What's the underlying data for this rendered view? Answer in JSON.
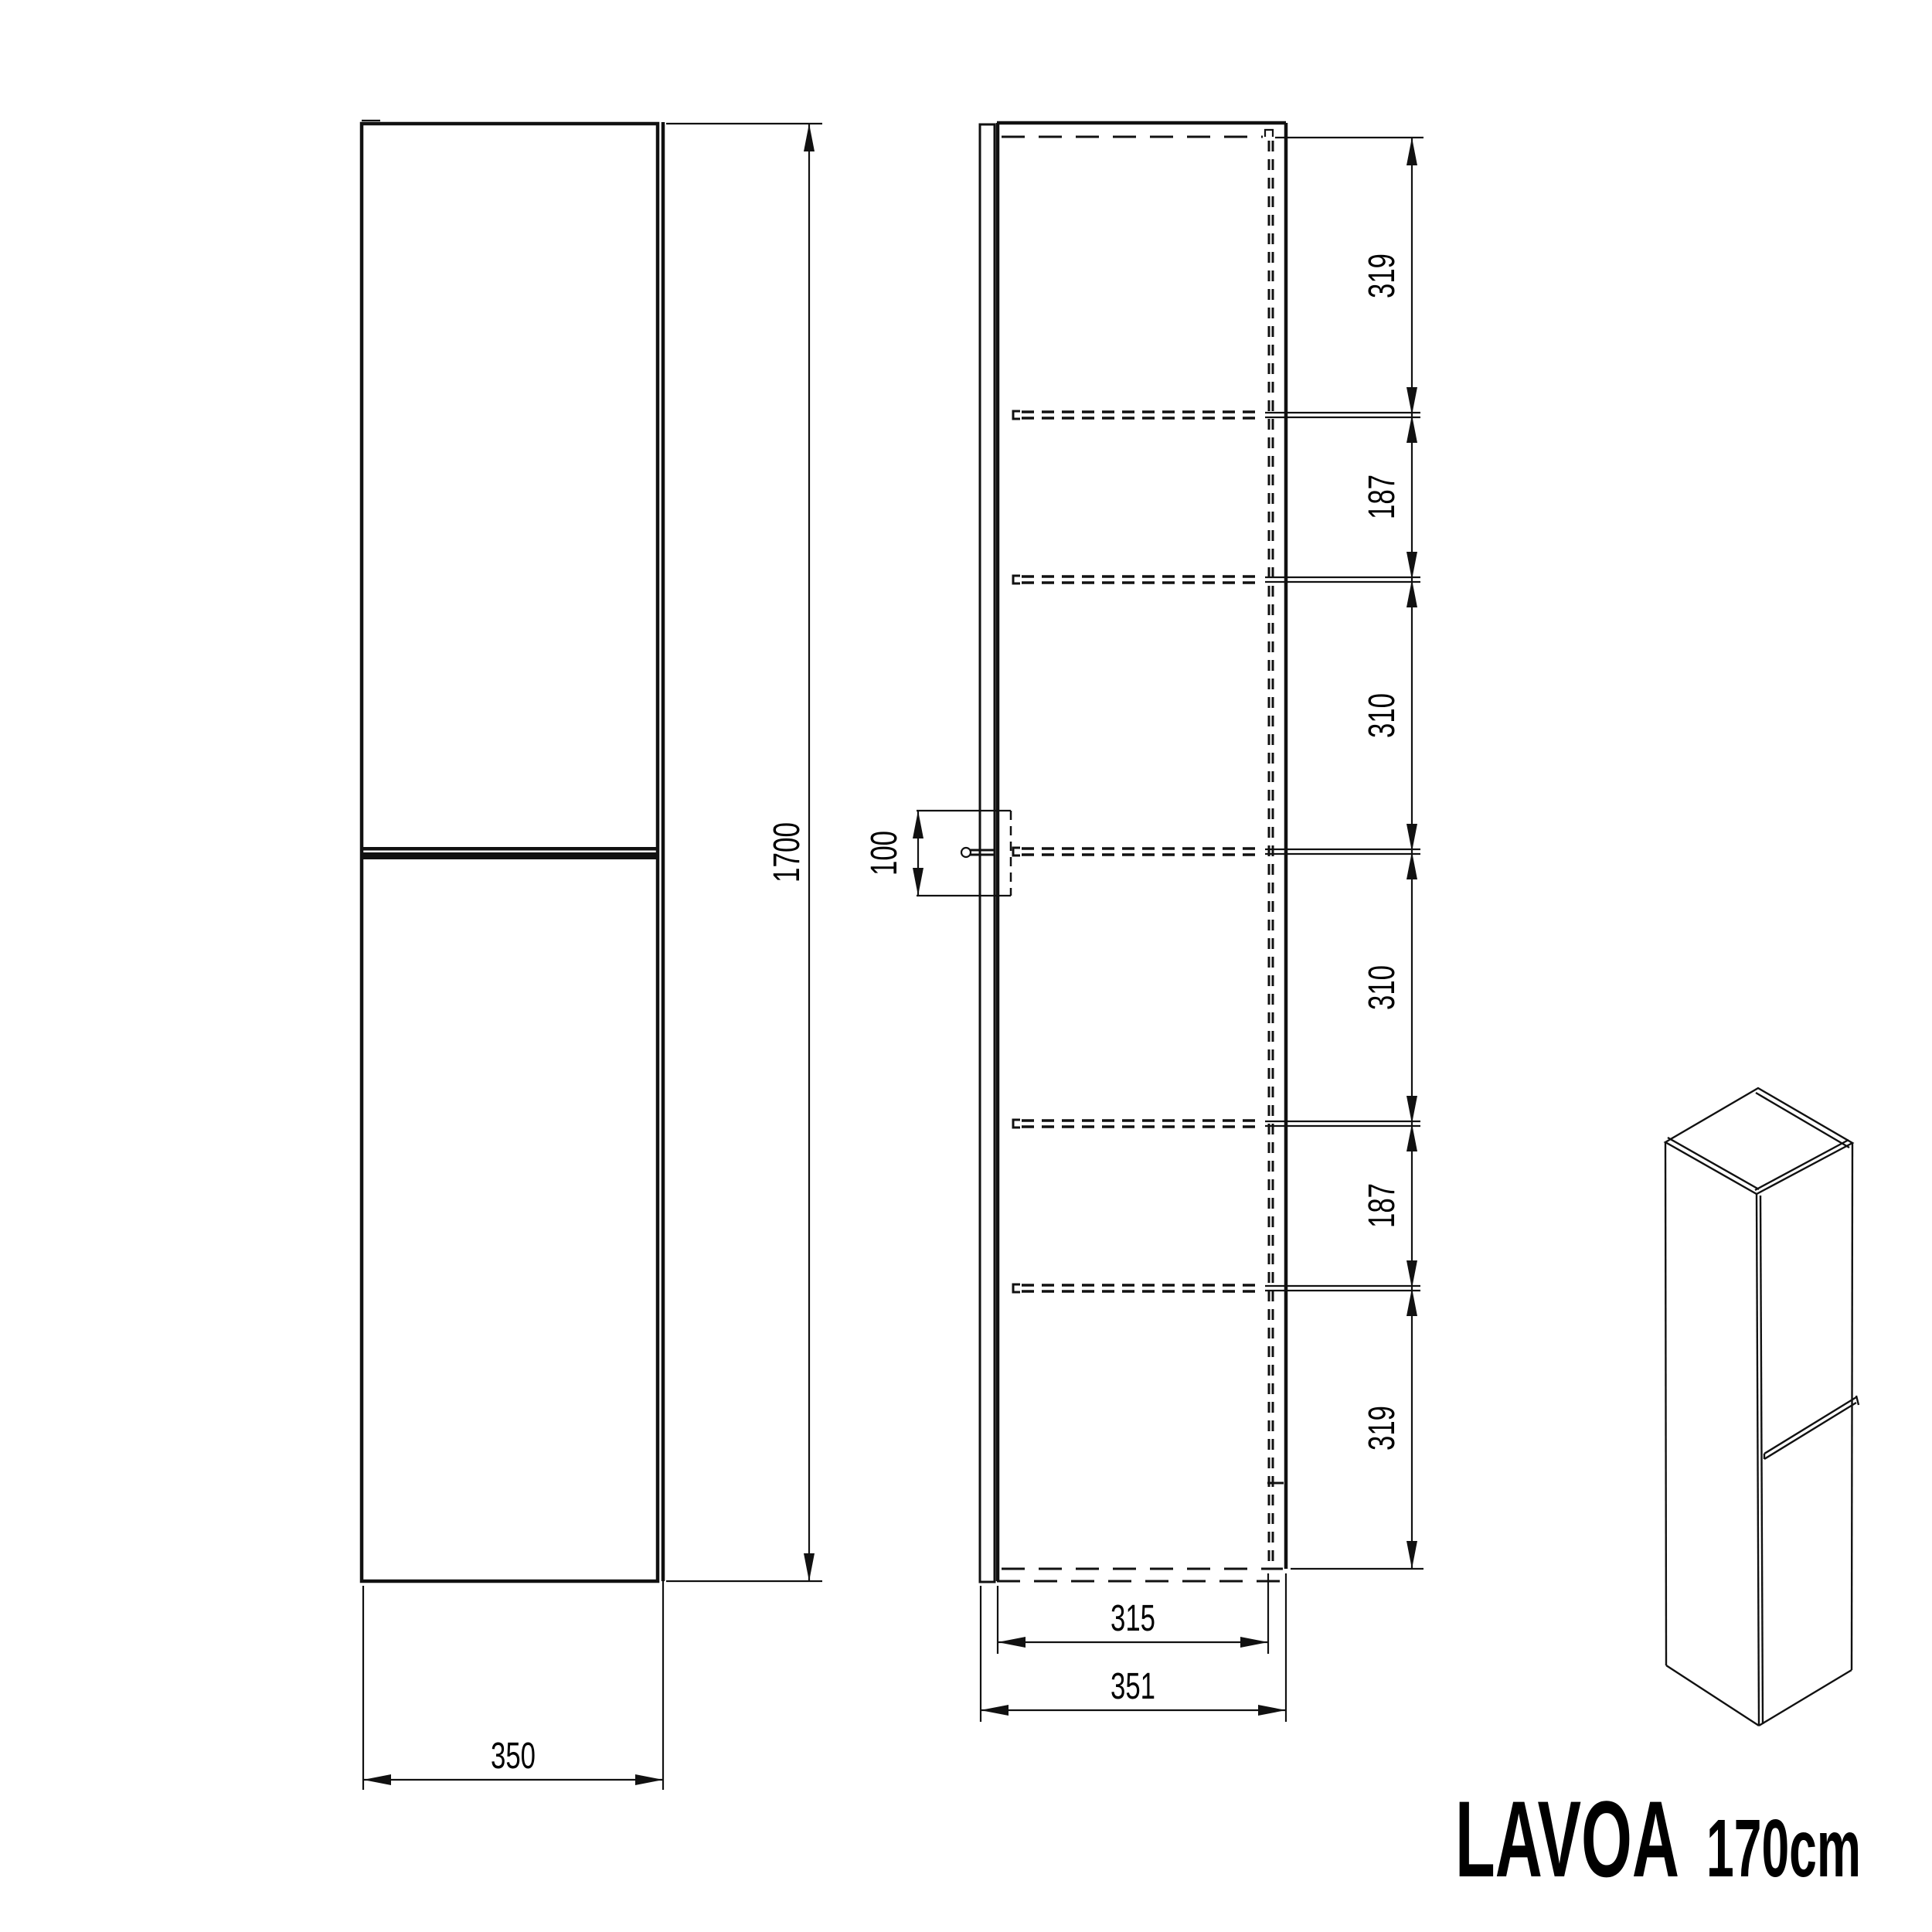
{
  "drawing": {
    "product_title": "LAVOA",
    "product_size": "170cm",
    "front_view": {
      "height": "1700",
      "width": "350"
    },
    "section_view": {
      "handle_offset": "100",
      "inner_width": "315",
      "outer_depth": "351",
      "vertical_segments": [
        "319",
        "187",
        "310",
        "310",
        "187",
        "319"
      ]
    }
  }
}
